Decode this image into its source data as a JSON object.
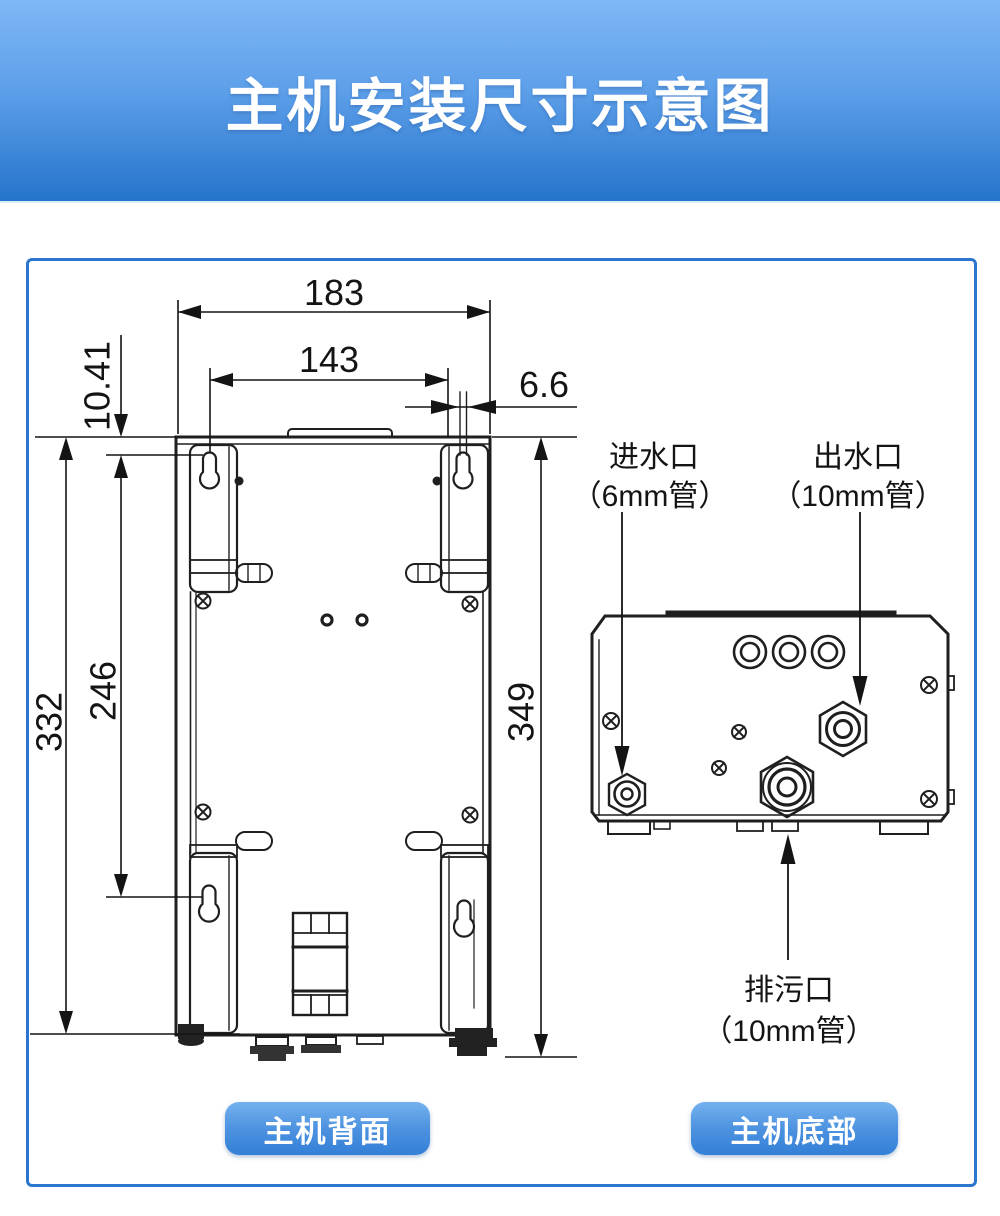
{
  "header": {
    "title": "主机安装尺寸示意图"
  },
  "back_view": {
    "caption": "主机背面",
    "dims": {
      "outer_width": "183",
      "mount_hole_span": "143",
      "stem_offset": "6.6",
      "hole_top_offset": "10.41",
      "body_height": "332",
      "mount_hole_vspan": "246",
      "overall_height": "349"
    }
  },
  "bottom_view": {
    "caption": "主机底部",
    "inlet_name": "进水口",
    "inlet_pipe": "（6mm管）",
    "outlet_name": "出水口",
    "outlet_pipe": "（10mm管）",
    "drain_name": "排污口",
    "drain_pipe": "（10mm管）"
  },
  "colors": {
    "banner_top": "#7fb8f6",
    "banner_bottom": "#2574cc",
    "panel_border": "#2b76cf",
    "button_blue": "#3380d7",
    "line_color": "#1f1f1f"
  }
}
